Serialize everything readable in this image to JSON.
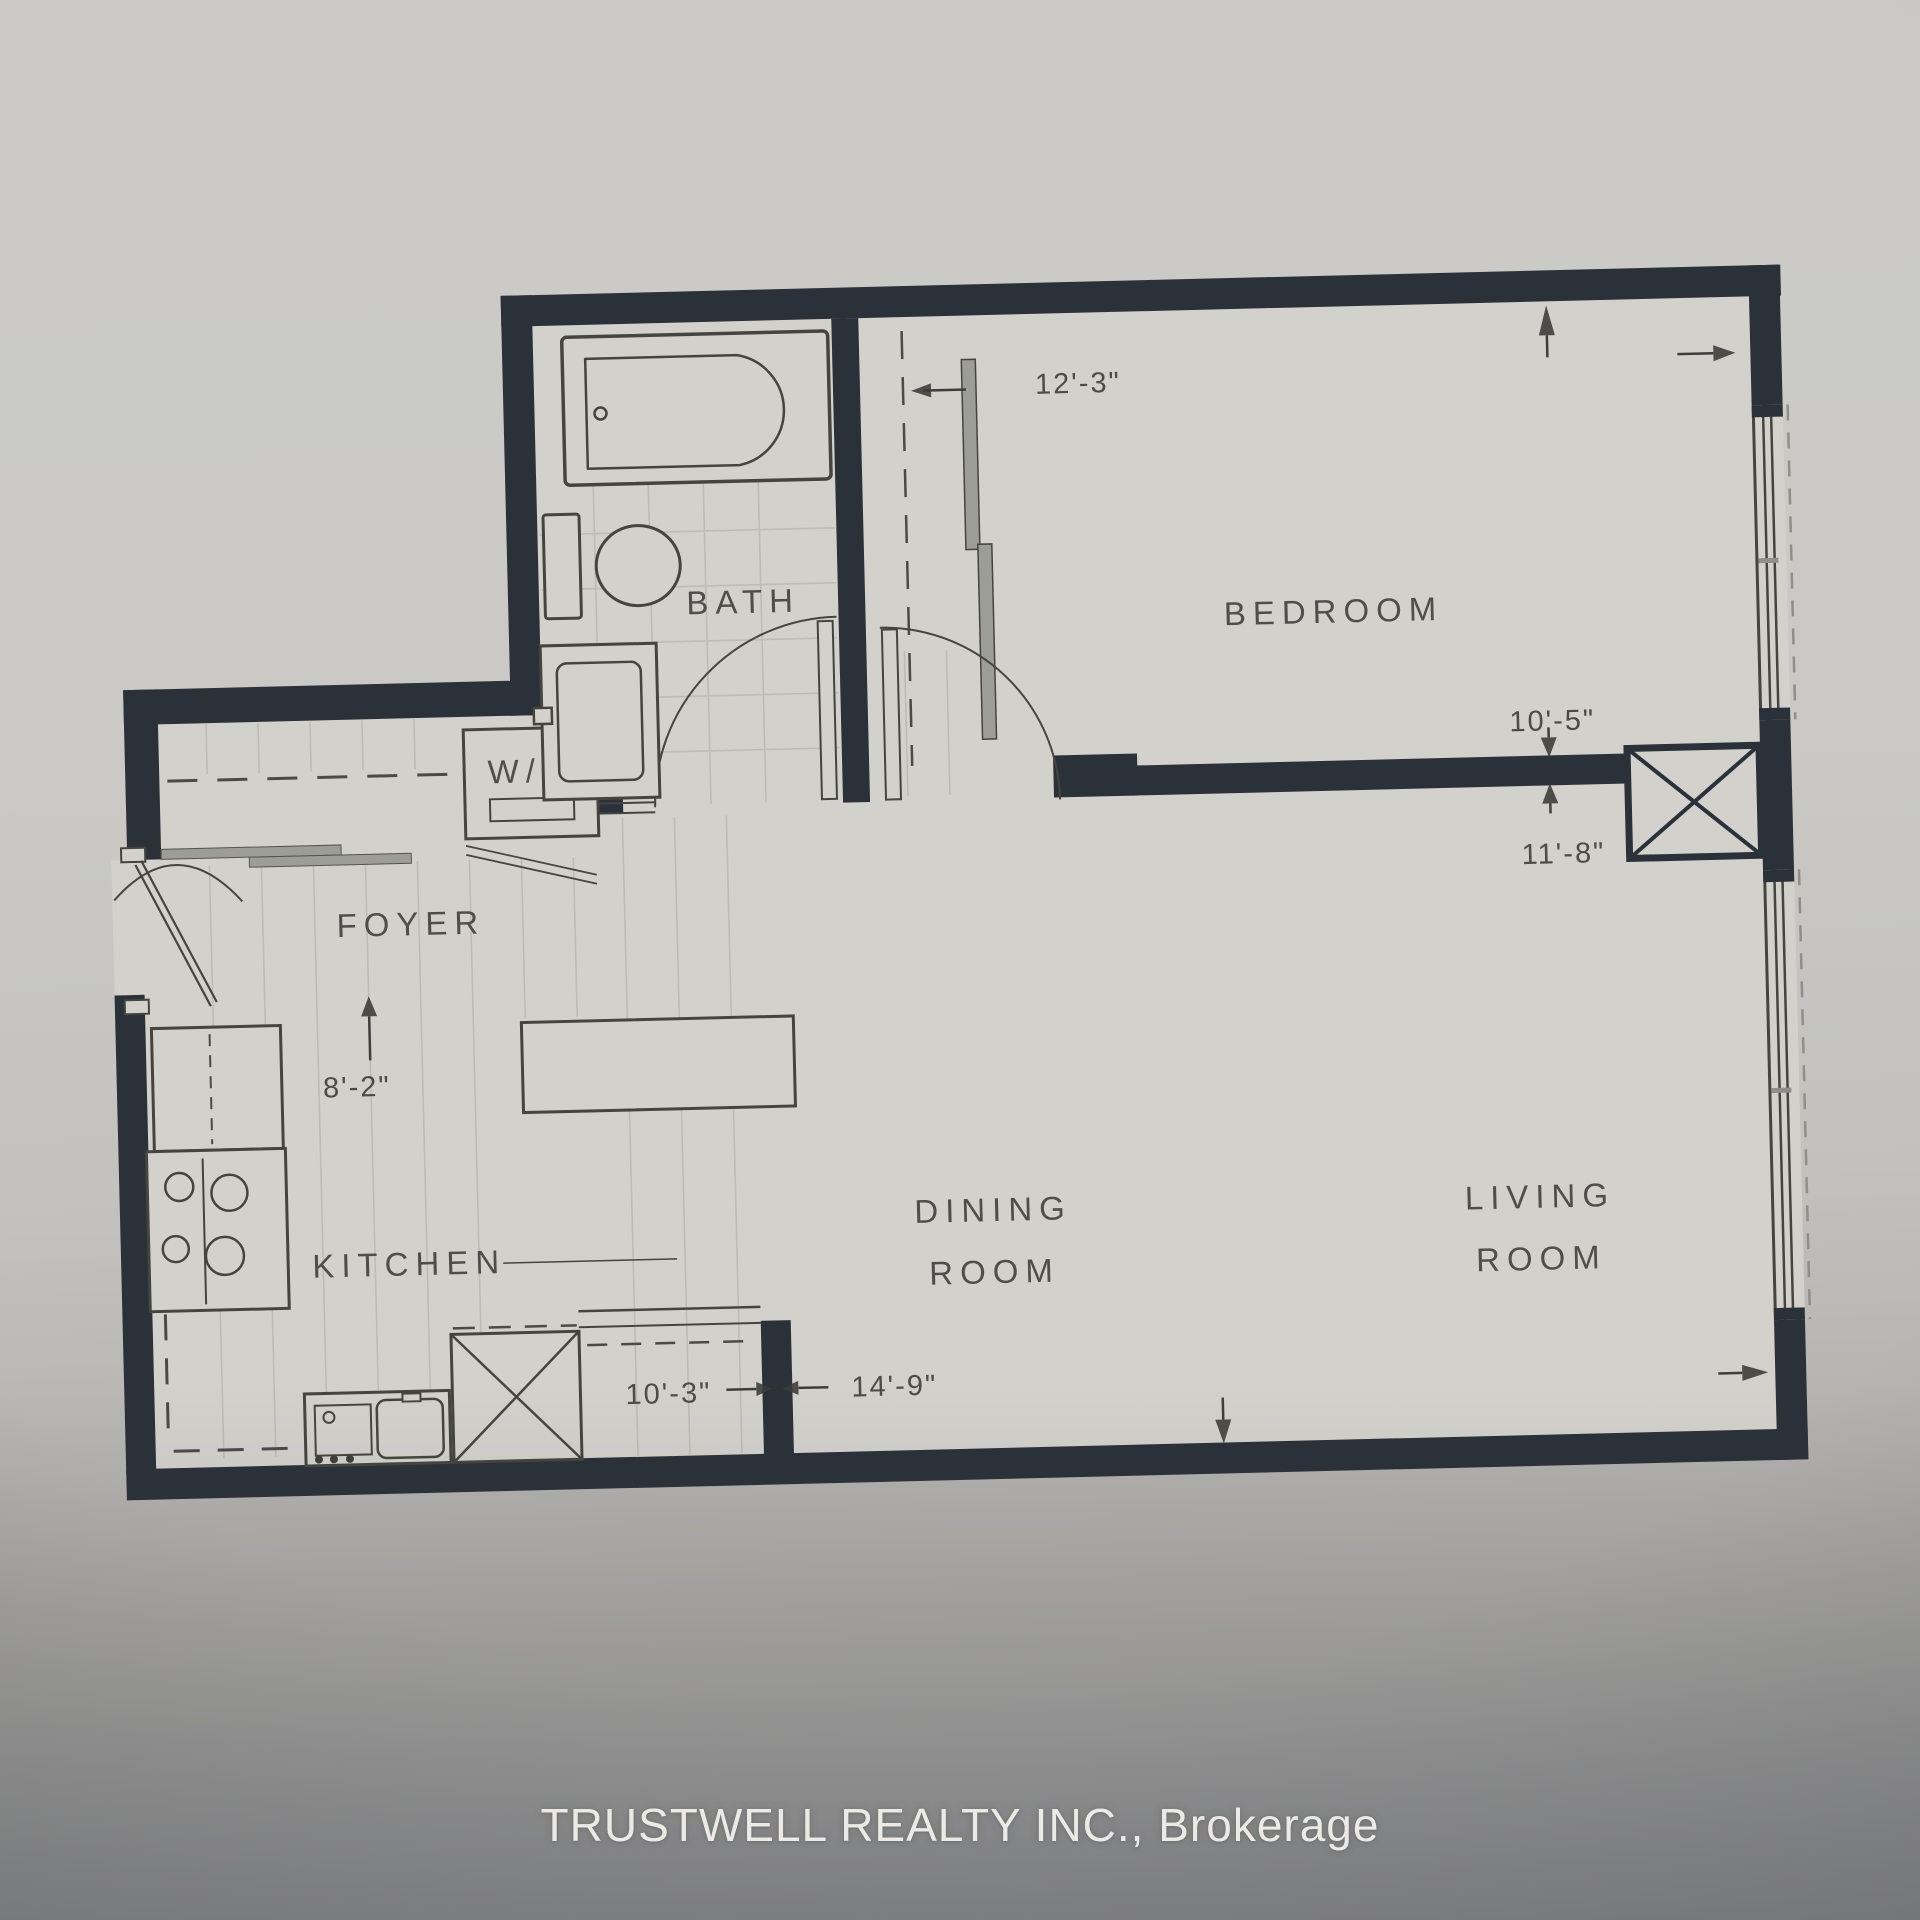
{
  "plan": {
    "rooms": {
      "bath": {
        "label": "BATH"
      },
      "bedroom": {
        "label": "BEDROOM"
      },
      "laundry": {
        "label": "W/D"
      },
      "foyer": {
        "label": "FOYER"
      },
      "kitchen": {
        "label": "KITCHEN"
      },
      "dining": {
        "line1": "DINING",
        "line2": "ROOM"
      },
      "living": {
        "line1": "LIVING",
        "line2": "ROOM"
      }
    },
    "dimensions": {
      "bedroom_width": "12'-3\"",
      "bedroom_depth": "10'-5\"",
      "living_width": "11'-8\"",
      "kitchen_width": "8'-2\"",
      "kitchen_depth": "10'-3\"",
      "living_depth": "14'-9\""
    },
    "footer": {
      "brokerage": "TRUSTWELL REALTY INC., Brokerage"
    },
    "colors": {
      "wall": "#2a3138",
      "paper": "#d2d1cc",
      "line": "#45453f",
      "tile_line": "#bdbcb7",
      "text": "#3d3d3a",
      "footer_text": "#eceae6"
    }
  }
}
